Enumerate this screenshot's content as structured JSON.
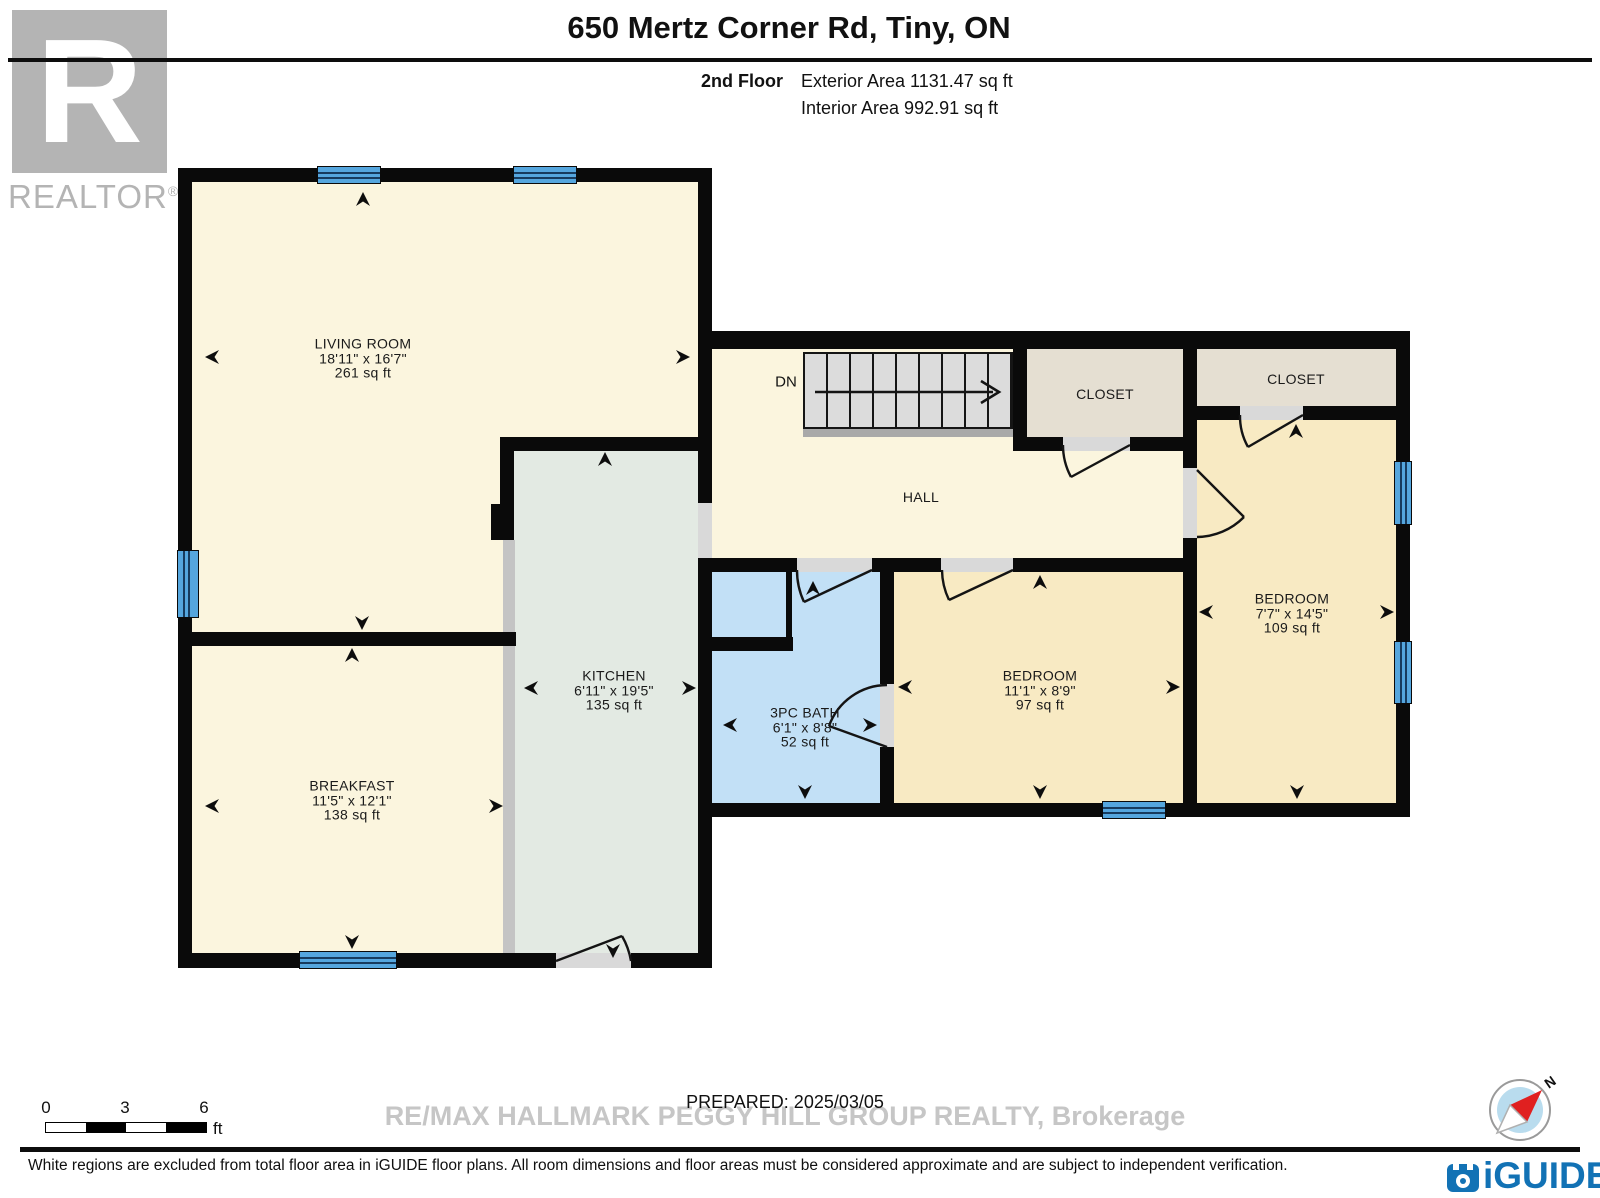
{
  "header": {
    "title": "650 Mertz Corner Rd, Tiny, ON",
    "floor_label": "2nd Floor",
    "exterior_area": "Exterior Area 1131.47 sq ft",
    "interior_area": "Interior Area 992.91 sq ft"
  },
  "branding": {
    "realtor_letter": "R",
    "realtor_text": "REALTOR",
    "realtor_reg": "®",
    "iguide_text": "iGUIDE",
    "compass_north": "N"
  },
  "rooms": {
    "living": {
      "name": "LIVING ROOM",
      "dims": "18'11\" x 16'7\"",
      "area": "261 sq ft"
    },
    "kitchen": {
      "name": "KITCHEN",
      "dims": "6'11\" x 19'5\"",
      "area": "135 sq ft"
    },
    "breakfast": {
      "name": "BREAKFAST",
      "dims": "11'5\" x 12'1\"",
      "area": "138 sq ft"
    },
    "hall": {
      "name": "HALL"
    },
    "closet1": {
      "name": "CLOSET"
    },
    "closet2": {
      "name": "CLOSET"
    },
    "bedroom_right": {
      "name": "BEDROOM",
      "dims": "7'7\" x 14'5\"",
      "area": "109 sq ft"
    },
    "bedroom_mid": {
      "name": "BEDROOM",
      "dims": "11'1\" x 8'9\"",
      "area": "97 sq ft"
    },
    "bath": {
      "name": "3PC BATH",
      "dims": "6'1\" x 8'8\"",
      "area": "52 sq ft"
    }
  },
  "stairs_label": "DN",
  "scale_bar": {
    "tick0": "0",
    "tick1": "3",
    "tick2": "6",
    "unit": "ft"
  },
  "footer": {
    "prepared": "PREPARED: 2025/03/05",
    "watermark": "RE/MAX HALLMARK PEGGY HILL GROUP REALTY, Brokerage",
    "disclaimer": "White regions are excluded from total floor area in iGUIDE floor plans. All room dimensions and floor areas must be considered approximate and are subject to independent verification."
  },
  "colors": {
    "wall": "#0a0a0a",
    "cream_room": "#fbf5de",
    "bedroom_tan": "#f8eac3",
    "kitchen_sage": "#e3eae3",
    "bath_blue": "#c2e0f6",
    "closet_beige": "#e5dfd2",
    "window_blue": "#55a6de",
    "iguide_blue": "#1272b5"
  }
}
